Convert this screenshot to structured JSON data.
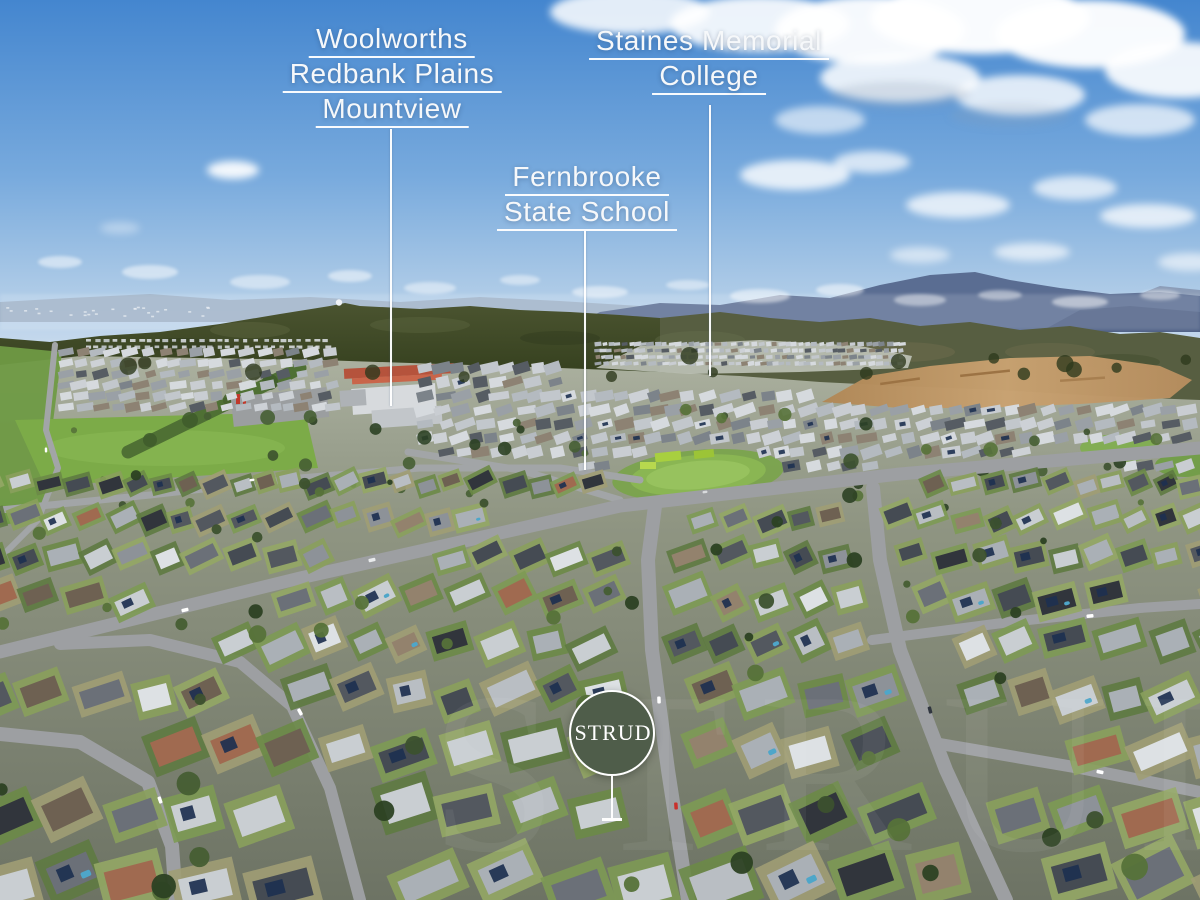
{
  "annotations": {
    "woolworths": {
      "lines": [
        "Woolworths",
        "Redbank Plains",
        "Mountview"
      ]
    },
    "staines": {
      "lines": [
        "Staines Memorial",
        "College"
      ]
    },
    "fernbrooke": {
      "lines": [
        "Fernbrooke",
        "State School"
      ]
    }
  },
  "badge": {
    "label": "STRUD"
  },
  "watermark": "STRUD",
  "colors": {
    "annotation_text": "#ffffff",
    "leader_line": "#ffffff",
    "badge_background": "#4f5d4a",
    "badge_border": "#ffffff",
    "badge_text": "#ffffff"
  }
}
